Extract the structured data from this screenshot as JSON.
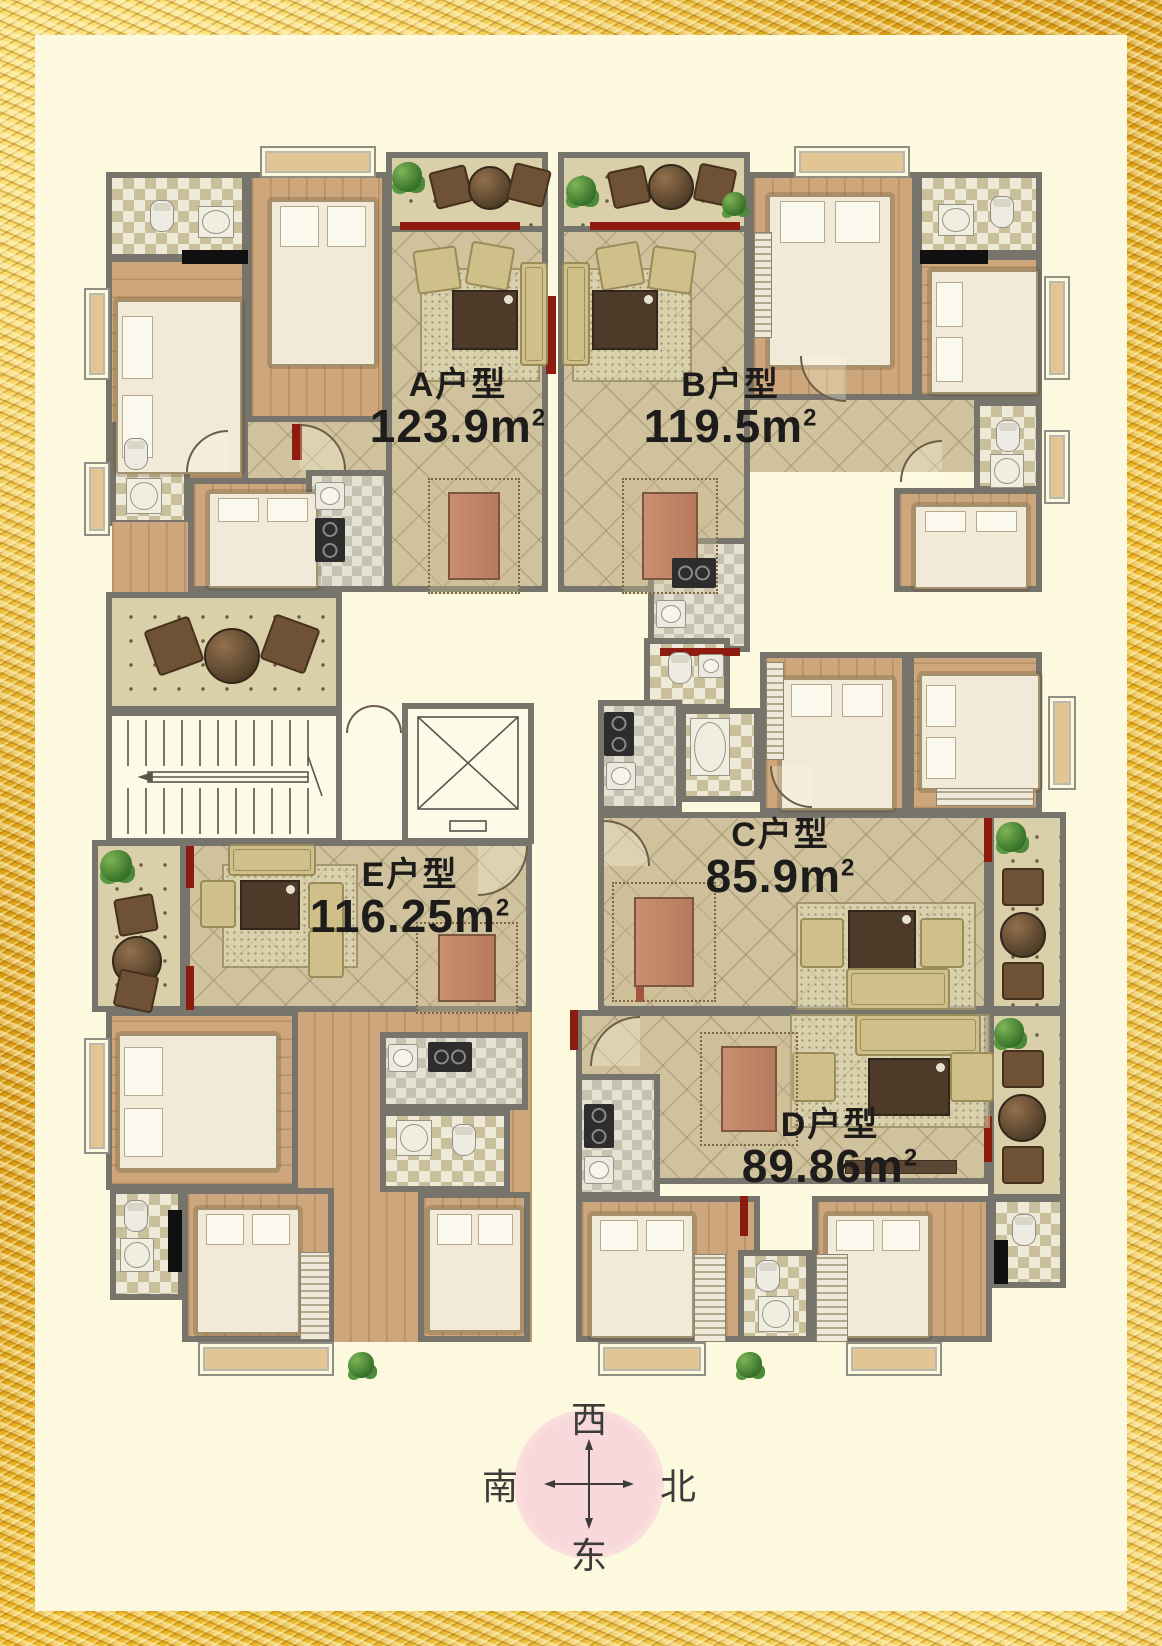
{
  "poster": {
    "type": "residential-floor-plan"
  },
  "units": [
    {
      "id": "A",
      "name": "A户型",
      "area": "123.9",
      "unit": "m",
      "sup": "2"
    },
    {
      "id": "B",
      "name": "B户型",
      "area": "119.5",
      "unit": "m",
      "sup": "2"
    },
    {
      "id": "C",
      "name": "C户型",
      "area": "85.9",
      "unit": "m",
      "sup": "2"
    },
    {
      "id": "D",
      "name": "D户型",
      "area": "89.86",
      "unit": "m",
      "sup": "2"
    },
    {
      "id": "E",
      "name": "E户型",
      "area": "116.25",
      "unit": "m",
      "sup": "2"
    }
  ],
  "compass": {
    "top": "西",
    "left": "南",
    "right": "北",
    "bottom": "东"
  },
  "colors": {
    "frame_gold": "#e2a916",
    "paper_cream": "#fcf9df",
    "wall_gray": "#77756b",
    "accent_red": "#8e1b10",
    "tile_floor": "#cfc29d",
    "wood_floor": "#cda77b",
    "bath_tile": "#c9bf9b",
    "balcony_dot_floor": "#d9cfa9",
    "compass_pink": "#f8d8dc",
    "label_text": "#1d1c1a"
  }
}
